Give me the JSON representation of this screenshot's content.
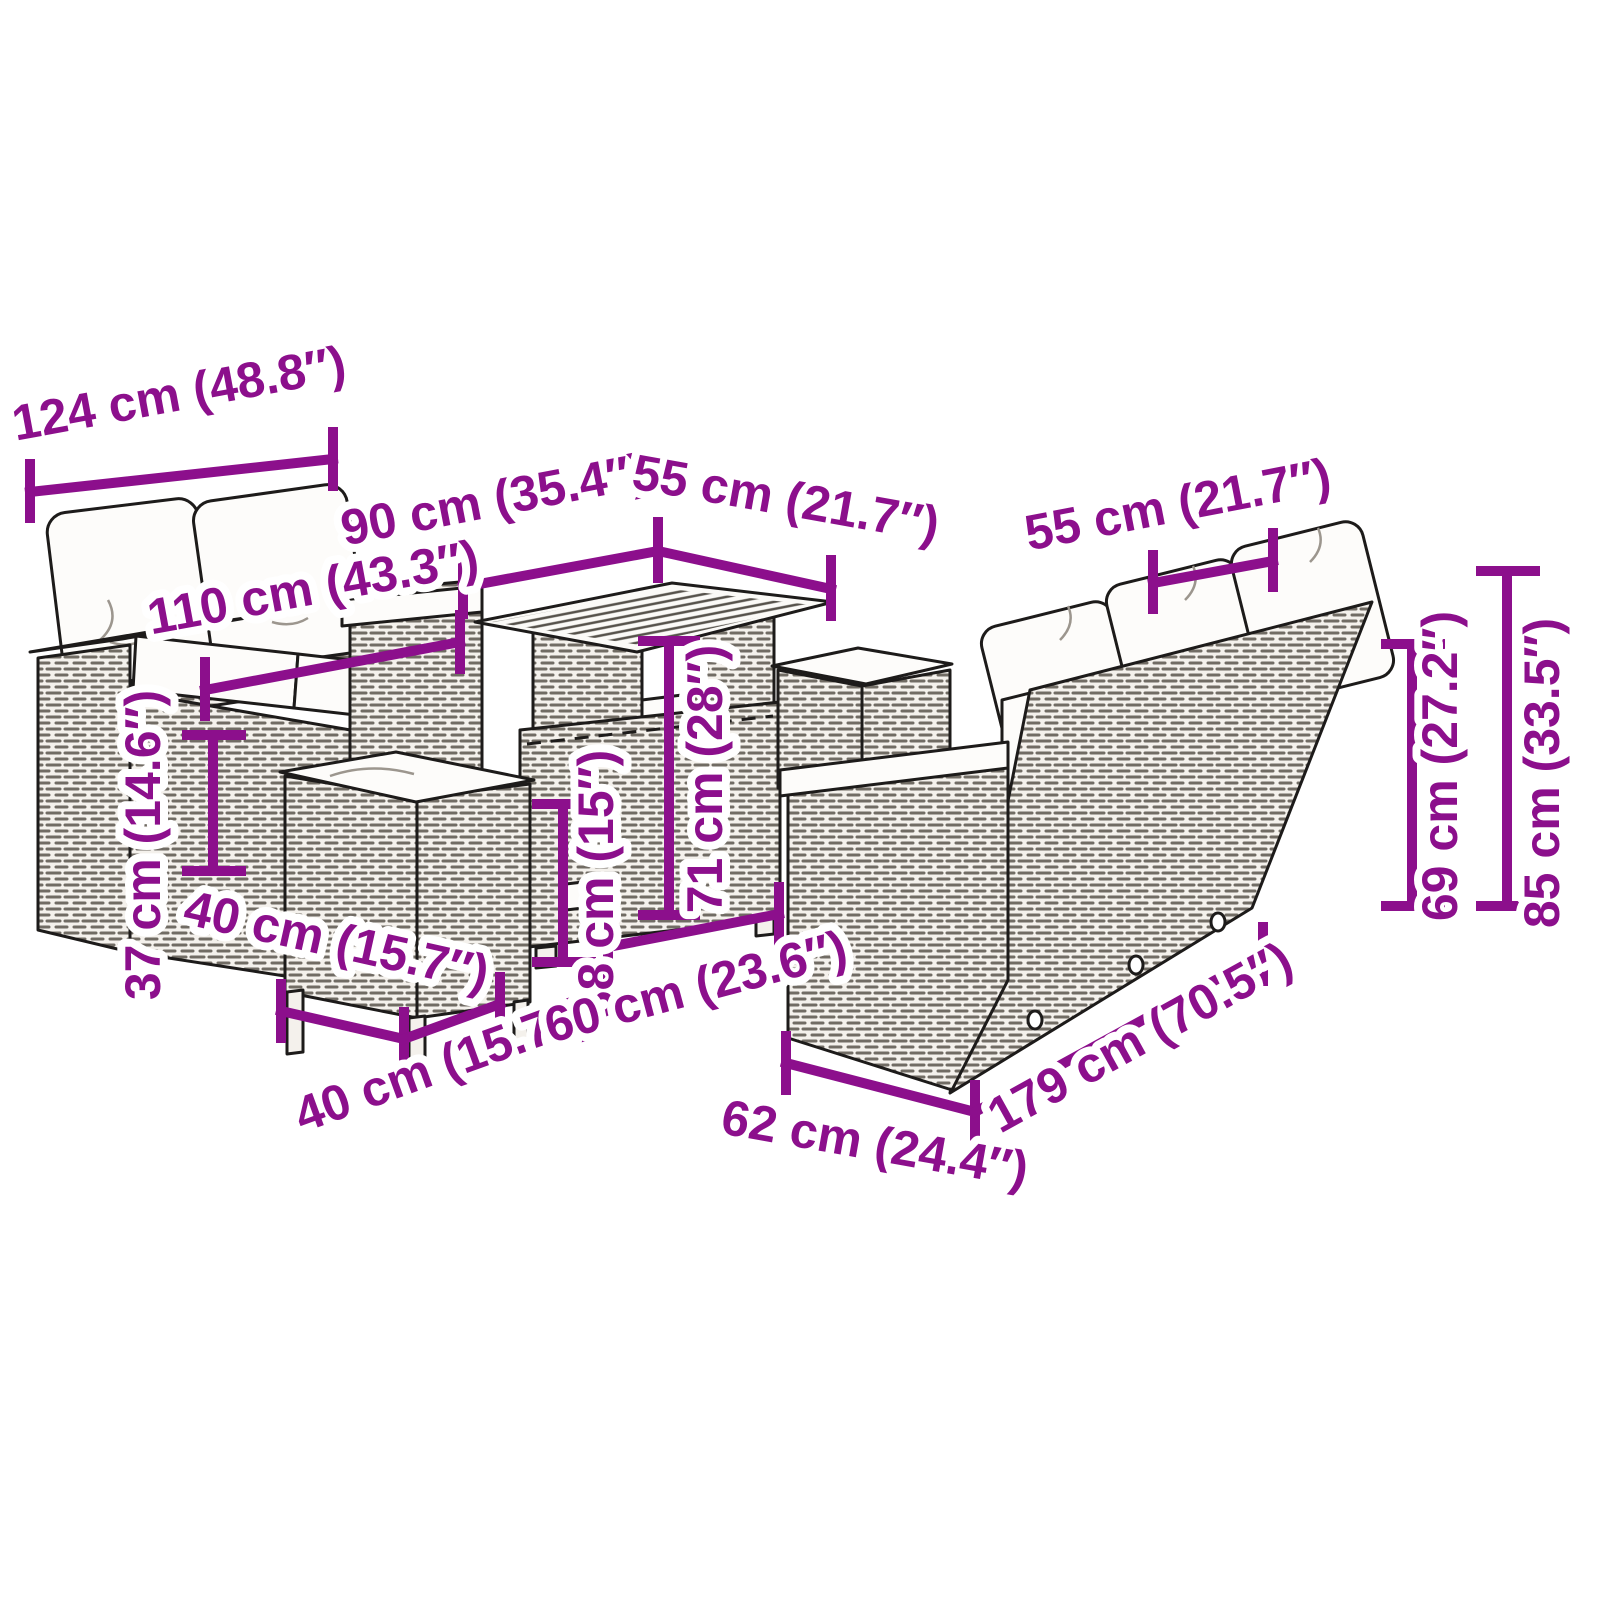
{
  "diagram": {
    "kind": "product-dimension-diagram",
    "scene": "outdoor poly-rattan furniture set: two-seater sofa, three-seater sofa, height-adjustable slatted table, two cushioned stools",
    "colors": {
      "dimension_accent": "#8C0F8C",
      "outline": "#1d1b1a",
      "cushion": "#fdfcfa",
      "background": "#ffffff"
    },
    "dimensions": {
      "sofa2_total_width": "124 cm (48.8″)",
      "sofa2_seat_width": "110 cm (43.3″)",
      "sofa2_seat_height": "37 cm (14.6″)",
      "table_length": "90 cm (35.4″)",
      "table_width": "55 cm (21.7″)",
      "table_height_low": "38 cm (15″)",
      "table_height_high": "71 cm (28″)",
      "stool_width": "40 cm (15.7″)",
      "stool_depth": "40 cm (15.7″)",
      "sofa3_seat_depth": "60 cm (23.6″)",
      "sofa3_arm_depth": "62 cm (24.4″)",
      "sofa3_total_width": "179 cm (70.5″)",
      "sofa3_back_height": "69 cm (27.2″)",
      "sofa3_total_height": "85 cm (33.5″)",
      "sofa3_seat_width": "55 cm (21.7″)"
    }
  }
}
